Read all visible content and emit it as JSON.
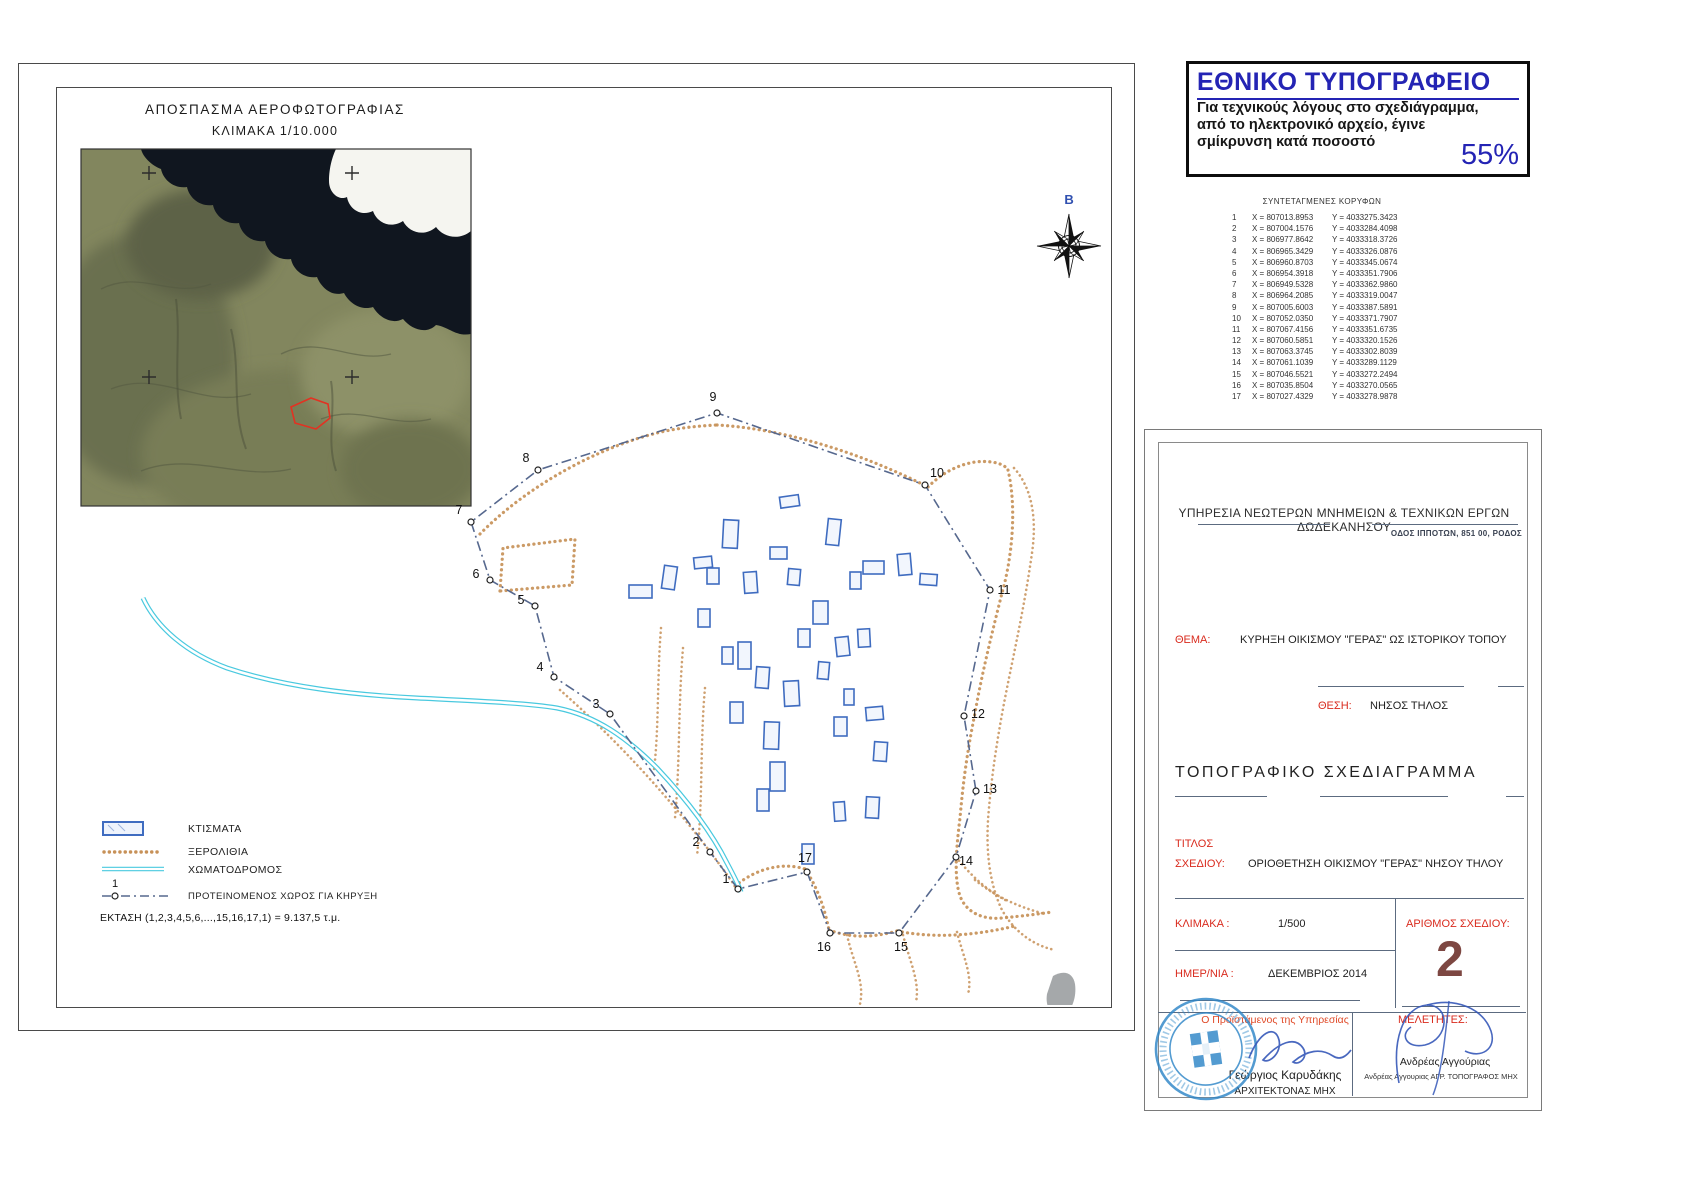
{
  "stamp": {
    "title": "ΕΘΝΙΚΟ ΤΥΠΟΓΡΑΦΕΙΟ",
    "line1": "Για τεχνικούς λόγους στο σχεδιάγραμμα,",
    "line2": "από το ηλεκτρονικό αρχείο, έγινε",
    "line3": "σμίκρυνση κατά ποσοστό",
    "percent": "55%"
  },
  "coords_table": {
    "title": "ΣΥΝΤΕΤΑΓΜΕΝΕΣ  ΚΟΡΥΦΩΝ",
    "rows": [
      {
        "n": "1",
        "x": "X = 807013.8953",
        "y": "Y = 4033275.3423"
      },
      {
        "n": "2",
        "x": "X = 807004.1576",
        "y": "Y = 4033284.4098"
      },
      {
        "n": "3",
        "x": "X = 806977.8642",
        "y": "Y = 4033318.3726"
      },
      {
        "n": "4",
        "x": "X = 806965.3429",
        "y": "Y = 4033326.0876"
      },
      {
        "n": "5",
        "x": "X = 806960.8703",
        "y": "Y = 4033345.0674"
      },
      {
        "n": "6",
        "x": "X = 806954.3918",
        "y": "Y = 4033351.7906"
      },
      {
        "n": "7",
        "x": "X = 806949.5328",
        "y": "Y = 4033362.9860"
      },
      {
        "n": "8",
        "x": "X = 806964.2085",
        "y": "Y = 4033319.0047"
      },
      {
        "n": "9",
        "x": "X = 807005.6003",
        "y": "Y = 4033387.5891"
      },
      {
        "n": "10",
        "x": "X = 807052.0350",
        "y": "Y = 4033371.7907"
      },
      {
        "n": "11",
        "x": "X = 807067.4156",
        "y": "Y = 4033351.6735"
      },
      {
        "n": "12",
        "x": "X = 807060.5851",
        "y": "Y = 4033320.1526"
      },
      {
        "n": "13",
        "x": "X = 807063.3745",
        "y": "Y = 4033302.8039"
      },
      {
        "n": "14",
        "x": "X = 807061.1039",
        "y": "Y = 4033289.1129"
      },
      {
        "n": "15",
        "x": "X = 807046.5521",
        "y": "Y = 4033272.2494"
      },
      {
        "n": "16",
        "x": "X = 807035.8504",
        "y": "Y = 4033270.0565"
      },
      {
        "n": "17",
        "x": "X = 807027.4329",
        "y": "Y = 4033278.9878"
      }
    ]
  },
  "map": {
    "title1": "ΑΠΟΣΠΑΣΜΑ  ΑΕΡΟΦΩΤΟΓΡΑΦΙΑΣ",
    "title2": "ΚΛΙΜΑΚΑ 1/10.000",
    "north_label": "B",
    "points": [
      {
        "n": "1",
        "x": 681,
        "y": 801,
        "lx": -12,
        "ly": -6
      },
      {
        "n": "2",
        "x": 653,
        "y": 764,
        "lx": -14,
        "ly": -6
      },
      {
        "n": "3",
        "x": 553,
        "y": 626,
        "lx": -14,
        "ly": -6
      },
      {
        "n": "4",
        "x": 497,
        "y": 589,
        "lx": -14,
        "ly": -6
      },
      {
        "n": "5",
        "x": 478,
        "y": 518,
        "lx": -14,
        "ly": -2
      },
      {
        "n": "6",
        "x": 433,
        "y": 492,
        "lx": -14,
        "ly": -2
      },
      {
        "n": "7",
        "x": 414,
        "y": 434,
        "lx": -12,
        "ly": -8
      },
      {
        "n": "8",
        "x": 481,
        "y": 382,
        "lx": -12,
        "ly": -8
      },
      {
        "n": "9",
        "x": 660,
        "y": 325,
        "lx": -4,
        "ly": -12
      },
      {
        "n": "10",
        "x": 868,
        "y": 397,
        "lx": 12,
        "ly": -8
      },
      {
        "n": "11",
        "x": 933,
        "y": 502,
        "lx": 14,
        "ly": 4
      },
      {
        "n": "12",
        "x": 907,
        "y": 628,
        "lx": 14,
        "ly": 2
      },
      {
        "n": "13",
        "x": 919,
        "y": 703,
        "lx": 14,
        "ly": 2
      },
      {
        "n": "14",
        "x": 899,
        "y": 769,
        "lx": 10,
        "ly": 8
      },
      {
        "n": "15",
        "x": 842,
        "y": 845,
        "lx": 2,
        "ly": 18
      },
      {
        "n": "16",
        "x": 773,
        "y": 845,
        "lx": -6,
        "ly": 18
      },
      {
        "n": "17",
        "x": 750,
        "y": 784,
        "lx": -2,
        "ly": -10
      }
    ],
    "legend": {
      "items": [
        {
          "label": "ΚΤΙΣΜΑΤΑ"
        },
        {
          "label": "ΞΕΡΟΛΙΘΙΑ"
        },
        {
          "label": "ΧΩΜΑΤΟΔΡΟΜΟΣ"
        },
        {
          "label": "ΠΡΟΤΕΙΝΟΜΕΝΟΣ ΧΩΡΟΣ ΓΙΑ ΚΗΡΥΞΗ"
        }
      ],
      "marker": "1",
      "area": "ΕΚΤΑΣΗ (1,2,3,4,5,6,...,15,16,17,1) = 9.137,5 τ.μ."
    }
  },
  "title_block": {
    "agency": "ΥΠΗΡΕΣΙΑ ΝΕΩΤΕΡΩΝ ΜΝΗΜΕΙΩΝ & ΤΕΧΝΙΚΩΝ ΕΡΓΩΝ ΔΩΔΕΚΑΝΗΣΟΥ",
    "address": "ΟΔΟΣ ΙΠΠΟΤΩΝ, 851 00, ΡΟΔΟΣ",
    "thema_label": "ΘΕΜΑ:",
    "thema_value": "ΚΥΡΗΞΗ ΟΙΚΙΣΜΟΥ \"ΓΕΡΑΣ\" ΩΣ ΙΣΤΟΡΙΚΟΥ ΤΟΠΟΥ",
    "thesi_label": "ΘΕΣΗ:",
    "thesi_value": "ΝΗΣΟΣ ΤΗΛΟΣ",
    "doc_type": "ΤΟΠΟΓΡΑΦΙΚΟ   ΣΧΕΔΙΑΓΡΑΜΜΑ",
    "titlos_label1": "ΤΙΤΛΟΣ",
    "titlos_label2": "ΣΧΕΔΙΟΥ:",
    "titlos_value": "ΟΡΙΟΘΕΤΗΣΗ ΟΙΚΙΣΜΟΥ \"ΓΕΡΑΣ\" ΝΗΣΟΥ ΤΗΛΟΥ",
    "klimaka_label": "ΚΛΙΜΑΚΑ :",
    "klimaka_value": "1/500",
    "arithmos_label": "ΑΡΙΘΜΟΣ  ΣΧΕΔΙΟΥ:",
    "arithmos_value": "2",
    "date_label": "ΗΜΕΡ/ΝΙΑ :",
    "date_value": "ΔΕΚΕΜΒΡΙΟΣ 2014",
    "signatures": {
      "left_role": "Ο Προϊστάμενος της Υπηρεσίας",
      "left_name": "Γεώργιος Καρυδάκης",
      "left_cert": "ΑΡΧΙΤΕΚΤΟΝΑΣ ΜΗΧ",
      "right_role": "ΜΕΛΕΤΗΤΕΣ:",
      "right_name": "Ανδρέας Αγγούριας",
      "right_cert": "Ανδρέας Αγγουριας  ΑΓΡ. ΤΟΠΟΓΡΑΦΟΣ ΜΗΧ"
    }
  },
  "colors": {
    "accent_blue": "#2424b4",
    "label_red": "#d92b1e",
    "seal_blue": "#2e86c8",
    "wall_orange": "#c79158",
    "road_cyan": "#49c9df",
    "building_blue": "#3f6cc0",
    "sheet_number_maroon": "#7d4742"
  }
}
